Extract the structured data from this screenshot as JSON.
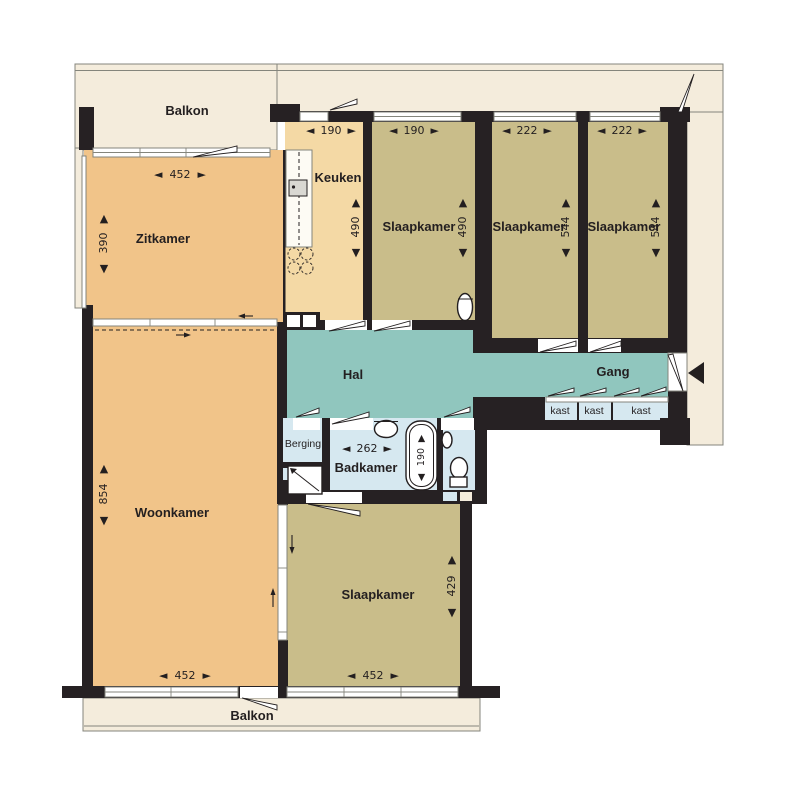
{
  "glyphs": {
    "arrow_left": "◄",
    "arrow_right": "►",
    "arrow_up": "▲",
    "arrow_down": "▼"
  },
  "colors": {
    "wall": "#262123",
    "living": "#f1c489",
    "kitchen": "#f4d9a5",
    "bedroom": "#c9bd8a",
    "hall": "#90c6be",
    "bath": "#d6e8f0",
    "balcony": "#f4ecdc",
    "line": "#84857c",
    "ink": "#231f20"
  },
  "balcony_top": {
    "label": "Balkon"
  },
  "balcony_bottom": {
    "label": "Balkon"
  },
  "rooms": {
    "zitkamer": {
      "label": "Zitkamer",
      "width_cm": "452",
      "depth_cm": "390"
    },
    "keuken": {
      "label": "Keuken",
      "width_cm": "190",
      "depth_cm": "490"
    },
    "slaapkamer_1": {
      "label": "Slaapkamer",
      "width_cm": "190",
      "depth_cm": "490"
    },
    "slaapkamer_2": {
      "label": "Slaapkamer",
      "width_cm": "222",
      "depth_cm": "544"
    },
    "slaapkamer_3": {
      "label": "Slaapkamer",
      "width_cm": "222",
      "depth_cm": "544"
    },
    "hal": {
      "label": "Hal"
    },
    "gang": {
      "label": "Gang"
    },
    "woonkamer": {
      "label": "Woonkamer",
      "width_cm": "452",
      "depth_cm": "854"
    },
    "slaapkamer_4": {
      "label": "Slaapkamer",
      "width_cm": "452",
      "depth_cm": "429"
    },
    "berging": {
      "label": "Berging"
    },
    "badkamer": {
      "label": "Badkamer",
      "width_cm": "262",
      "bath_length_cm": "190"
    },
    "kast_1": {
      "label": "kast"
    },
    "kast_2": {
      "label": "kast"
    },
    "kast_3": {
      "label": "kast"
    }
  }
}
